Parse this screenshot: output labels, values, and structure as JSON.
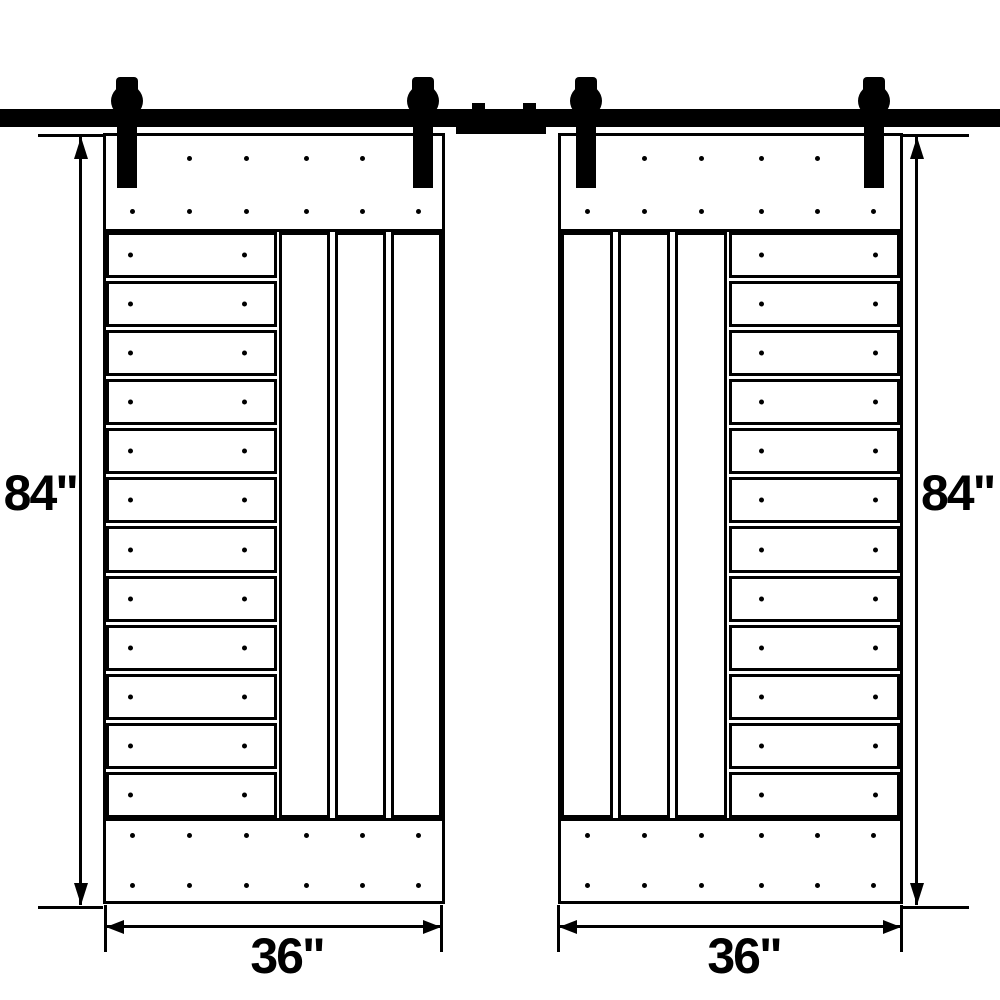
{
  "diagram": {
    "type": "double-sliding-barn-door-dimension-diagram",
    "colors": {
      "line": "#000000",
      "background": "#ffffff"
    },
    "dimensions": {
      "left_door_height": "84\"",
      "right_door_height": "84\"",
      "left_door_width": "36\"",
      "right_door_width": "36\""
    },
    "structure": {
      "door_count": 2,
      "hangers_per_door": 2,
      "horizontal_planks_per_door": 12,
      "vertical_boards_per_door": 3,
      "band_dot_columns": 6,
      "band_dot_rows": 2,
      "plank_dots_per_plank": 2
    }
  }
}
